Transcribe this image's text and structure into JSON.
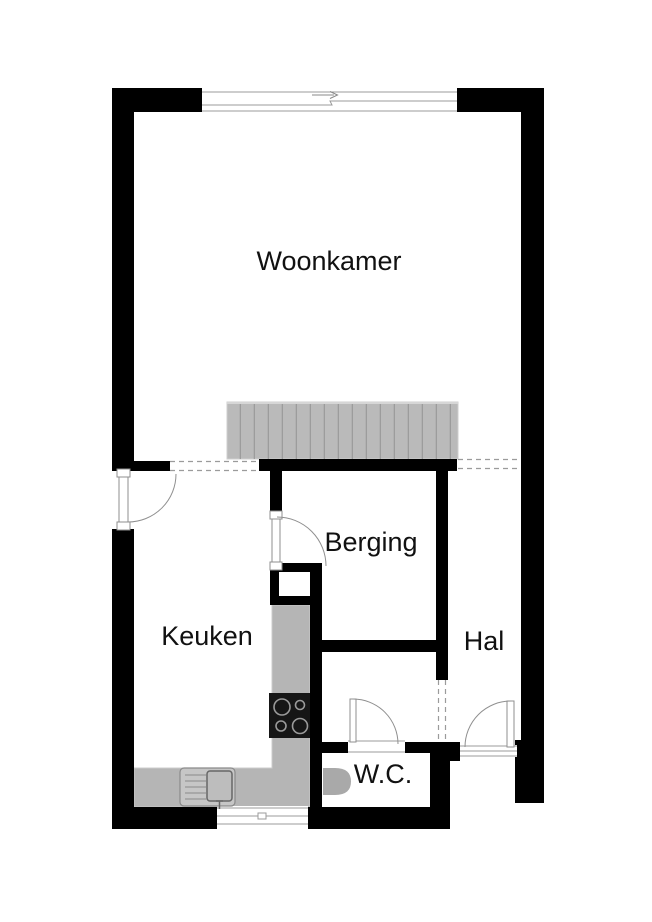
{
  "floorplan": {
    "type": "floor-plan",
    "labels": {
      "woonkamer": "Woonkamer",
      "keuken": "Keuken",
      "berging": "Berging",
      "hal": "Hal",
      "wc": "W.C."
    },
    "fixtures": {
      "stairs": "staircase",
      "counter": "kitchen-counter",
      "stove": "cooktop-4-burners",
      "sink": "kitchen-sink",
      "toilet": "toilet",
      "top_window": "sliding-door",
      "bottom_window": "window",
      "hal_panel": "interior-window-panel"
    },
    "colors": {
      "wall": "#000000",
      "floor": "#ffffff",
      "stairs_fill": "#bababa",
      "stairs_tread": "#9c9c9c",
      "stairs_edge": "#d6d6d6",
      "counter_fill": "#b5b5b5",
      "counter_edge": "#cccccc",
      "stove_fill": "#161616",
      "burner_ring": "#9a9a9a",
      "sink_fill": "#c6c6c6",
      "basin_fill": "#bdbdbd",
      "toilet_fill": "#a9a9a9",
      "label_color": "#111111"
    }
  }
}
